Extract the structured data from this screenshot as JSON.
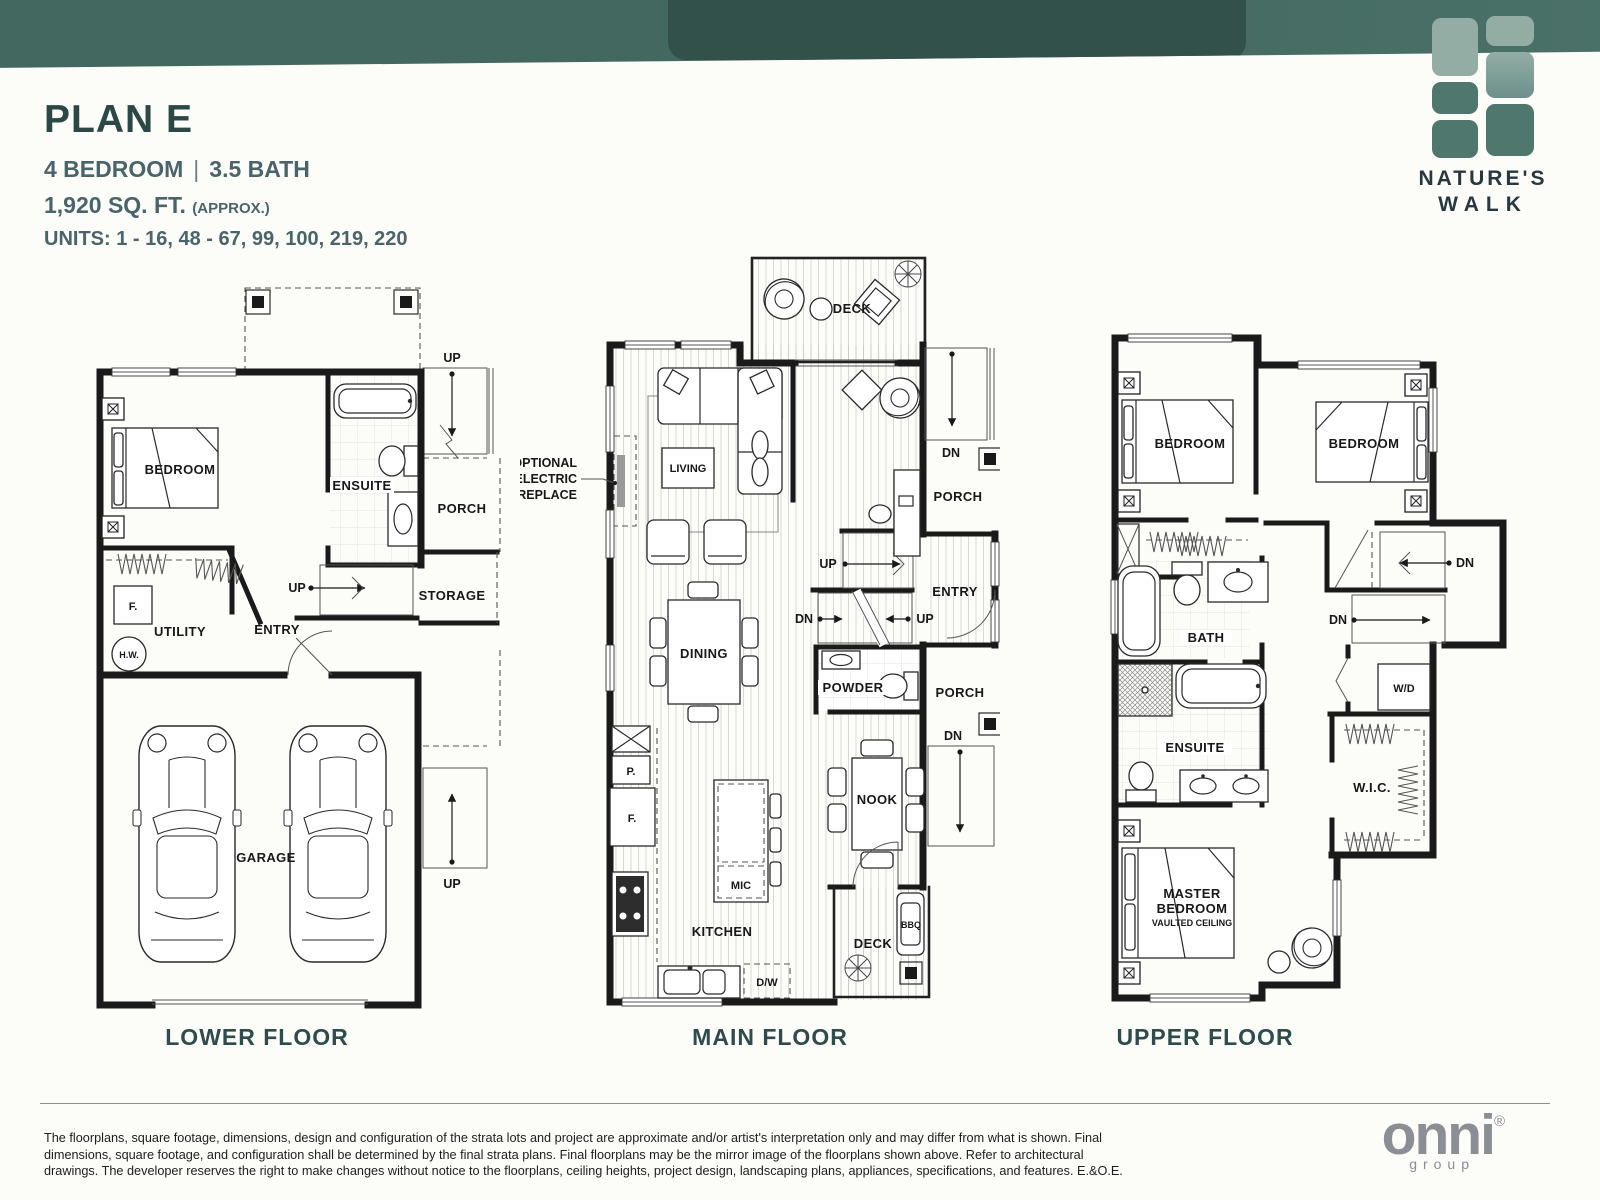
{
  "header": {
    "plan_title": "PLAN E",
    "bedrooms": "4 BEDROOM",
    "separator": "|",
    "baths": "3.5 BATH",
    "area": "1,920 SQ. FT.",
    "area_note": "(APPROX.)",
    "units": "UNITS: 1 - 16, 48 - 67, 99, 100, 219, 220"
  },
  "brand": {
    "line1": "NATURE'S",
    "line2": "WALK"
  },
  "stair_labels": {
    "up": "UP",
    "dn": "DN"
  },
  "floors": {
    "lower": {
      "caption": "LOWER FLOOR",
      "rooms": {
        "bedroom": "BEDROOM",
        "ensuite": "ENSUITE",
        "porch": "PORCH",
        "storage": "STORAGE",
        "entry": "ENTRY",
        "utility": "UTILITY",
        "garage": "GARAGE",
        "furnace": "F.",
        "hot_water": "H.W."
      }
    },
    "main": {
      "caption": "MAIN FLOOR",
      "rooms": {
        "deck": "DECK",
        "living": "LIVING",
        "dining": "DINING",
        "kitchen": "KITCHEN",
        "nook": "NOOK",
        "powder": "POWDER",
        "entry": "ENTRY",
        "porch_upper": "PORCH",
        "porch_lower": "PORCH",
        "deck_rear": "DECK",
        "bbq": "BBQ",
        "microwave": "MIC",
        "dishwasher": "D/W",
        "pantry": "P.",
        "fridge": "F."
      },
      "fireplace_note": [
        "OPTIONAL",
        "ELECTRIC",
        "FIREPLACE"
      ]
    },
    "upper": {
      "caption": "UPPER FLOOR",
      "rooms": {
        "bedroom": "BEDROOM",
        "bath": "BATH",
        "ensuite": "ENSUITE",
        "walk_in_closet": "W.I.C.",
        "washer_dryer": "W/D",
        "master_line1": "MASTER",
        "master_line2": "BEDROOM",
        "master_line3": "VAULTED CEILING"
      }
    }
  },
  "footer": {
    "disclaimer": "The floorplans, square footage, dimensions, design and configuration of the strata lots and project are approximate and/or artist's interpretation only and may differ from what is shown. Final dimensions, square footage, and configuration shall be determined by the final strata plans. Final floorplans may be the mirror image of the floorplans shown above. Refer to architectural drawings. The developer reserves the right to make changes without notice to the floorplans, ceiling heights, project design, landscaping plans, appliances, specifications, and features. E.&O.E.",
    "logo": "onni",
    "logo_reg": "®",
    "logo_sub": "group"
  },
  "colors": {
    "banner": "#43685f",
    "banner-dark": "#33514b",
    "logo-light": "#93ada5",
    "logo-mid": "#6d908a",
    "logo-dark": "#4f776d",
    "heading": "#2c4846",
    "subheading": "#49646b",
    "caption": "#2e4b4d",
    "ink": "#1a1a1a",
    "onni-gray": "#8b8e94"
  }
}
